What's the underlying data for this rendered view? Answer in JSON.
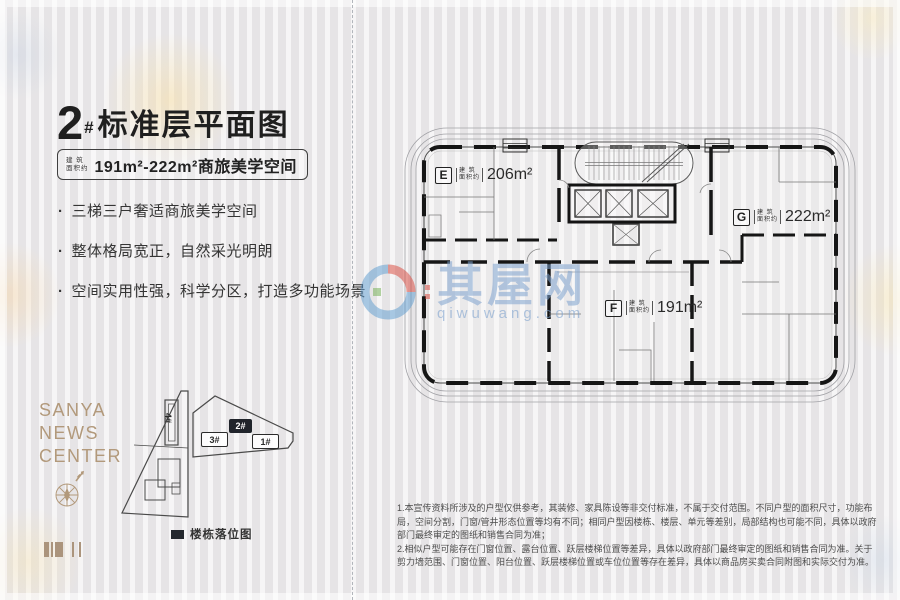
{
  "left_panel": {
    "title": {
      "num": "2",
      "hash": "#",
      "name": "标准层平面图"
    },
    "area_badge": {
      "prefix_top": "建 筑",
      "prefix_bottom": "面积约",
      "range": "191m²-222m²商旅美学空间"
    },
    "bullets": [
      "三梯三户奢适商旅美学空间",
      "整体格局宽正，自然采光明朗",
      "空间实用性强，科学分区，打造多功能场景"
    ],
    "brand": {
      "line1": "SANYA",
      "line2": "NEWS",
      "line3": "CENTER"
    },
    "siteplan": {
      "b1": "1#",
      "b2": "2#",
      "b3": "3#",
      "b4": "4#",
      "legend": "楼栋落位图"
    }
  },
  "floorplan": {
    "prefix_top": "建 筑",
    "prefix_bottom": "面积约",
    "unit_e": {
      "id": "E",
      "area": "206m²"
    },
    "unit_g": {
      "id": "G",
      "area": "222m²"
    },
    "unit_f": {
      "id": "F",
      "area": "191m²"
    }
  },
  "watermark": {
    "cn": "其屋网",
    "en": "qiwuwang.com"
  },
  "disclaimer": {
    "p1": "1.本宣传资料所涉及的户型仅供参考，其装修、家具陈设等非交付标准，不属于交付范围。不同户型的面积尺寸，功能布局，空间分割，门窗/管井形态位置等均有不同；相同户型因楼栋、楼层、单元等差别，局部结构也可能不同，具体以政府部门最终审定的图纸和销售合同为准；",
    "p2": "2.相似户型可能存在门窗位置、露台位置、跃层楼梯位置等差异，具体以政府部门最终审定的图纸和销售合同为准。关于剪力墙范围、门窗位置、阳台位置、跃层楼梯位置或车位位置等存在差异，具体以商品房买卖合同附图和实际交付为准。"
  },
  "colors": {
    "accent_tan": "#b2997b",
    "wall_black": "#161616",
    "watermark_blue": "#7ea3ce",
    "watermark_red": "#d9453a",
    "logo_green": "#6fae4e"
  }
}
